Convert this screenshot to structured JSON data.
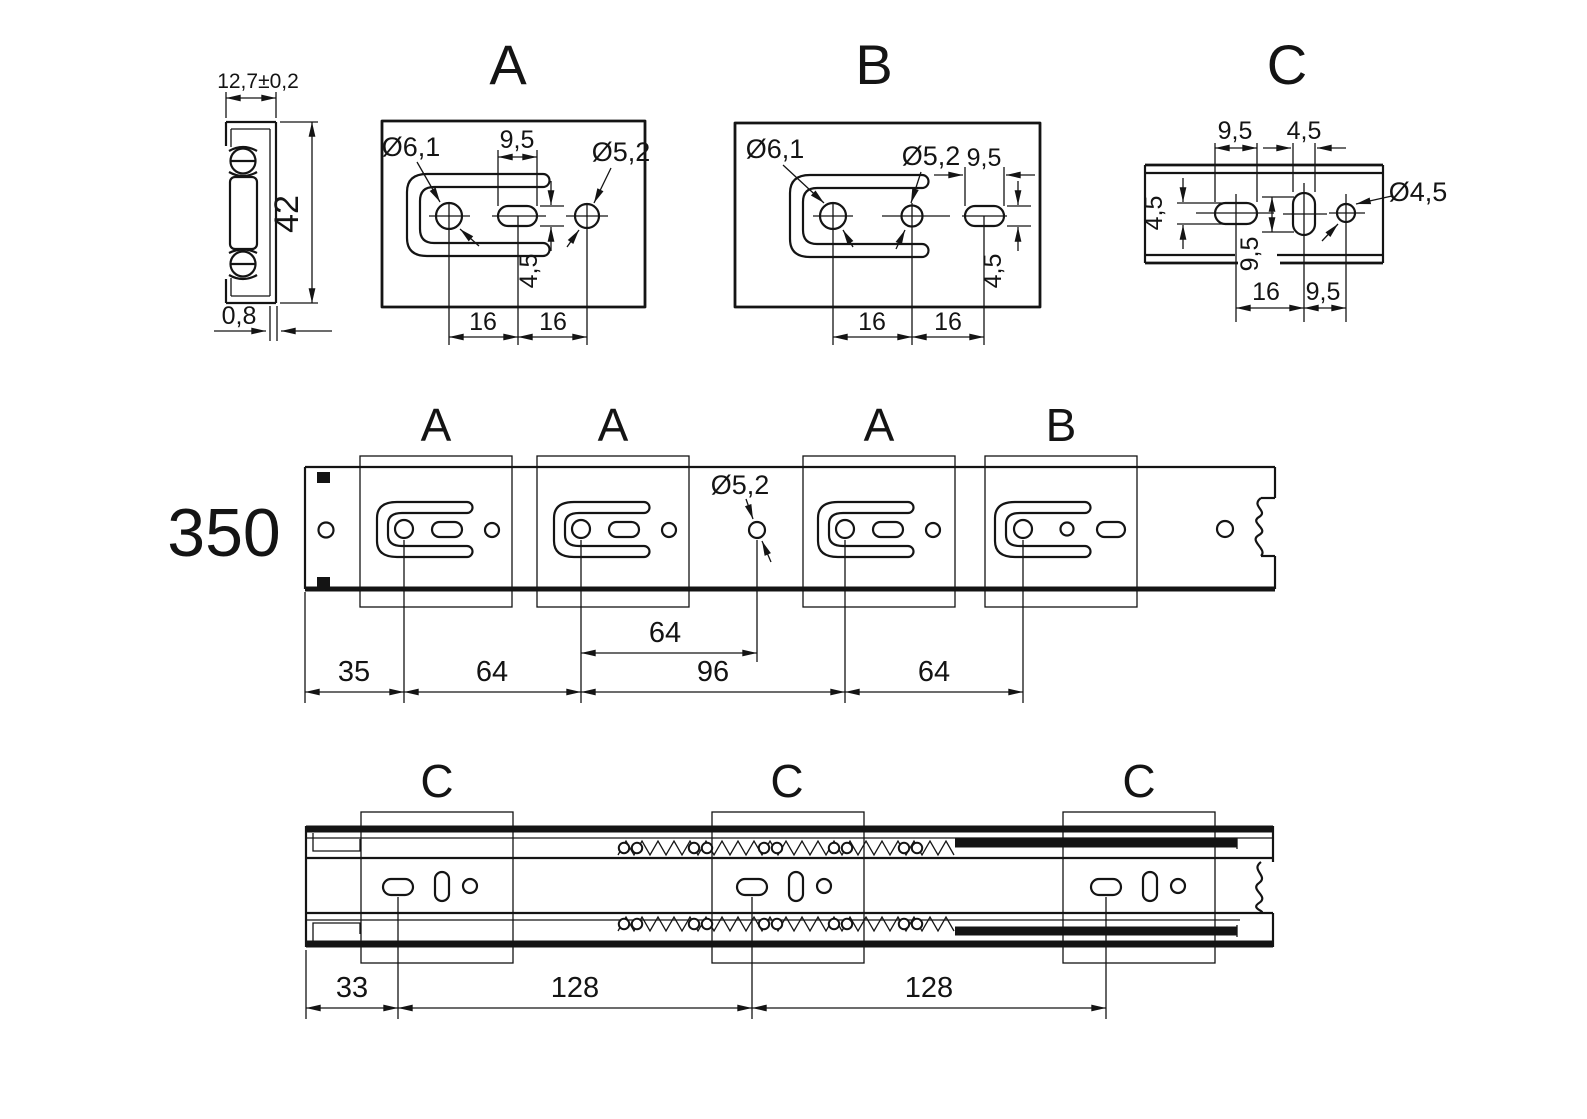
{
  "drawing": {
    "cross_section": {
      "width": "12,7±0,2",
      "height": "42",
      "thickness": "0,8"
    },
    "detail_a": {
      "label": "A",
      "hole_dia": "Ø6,1",
      "hole2_dia": "Ø5,2",
      "slot_width": "9,5",
      "slot_height": "4,5",
      "pitch_1": "16",
      "pitch_2": "16"
    },
    "detail_b": {
      "label": "B",
      "hole_dia": "Ø6,1",
      "hole2_dia": "Ø5,2",
      "slot_width": "9,5",
      "slot_height": "4,5",
      "pitch_1": "16",
      "pitch_2": "16"
    },
    "detail_c": {
      "label": "C",
      "slot_width": "9,5",
      "slot2_width": "4,5",
      "slot_height": "4,5",
      "slot2_height": "9,5",
      "hole_dia": "Ø4,5",
      "pitch_1": "16",
      "pitch_2": "9,5"
    },
    "middle_rail": {
      "length": "350",
      "callouts": [
        "A",
        "A",
        "A",
        "B"
      ],
      "hole_dia": "Ø5,2",
      "pitch_upper": "64",
      "offsets": [
        "35",
        "64",
        "96",
        "64"
      ]
    },
    "bottom_rail": {
      "callouts": [
        "C",
        "C",
        "C"
      ],
      "offsets": [
        "33",
        "128",
        "128"
      ]
    }
  }
}
